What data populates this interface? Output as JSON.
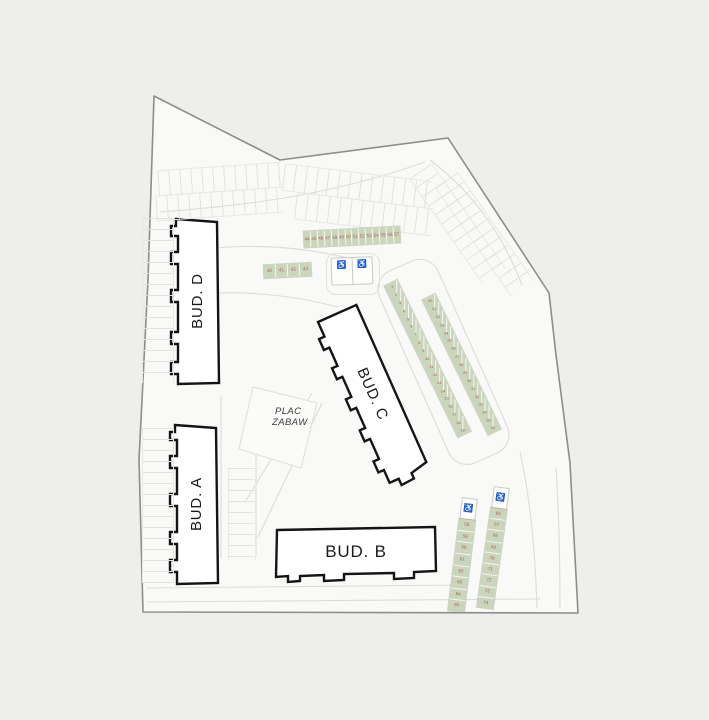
{
  "site_plan": {
    "buildings": {
      "building_d": "BUD. D",
      "building_a": "BUD. A",
      "building_c": "BUD. C",
      "building_b": "BUD. B"
    },
    "playground": {
      "line1": "PLAC",
      "line2": "ZABAW"
    },
    "parking": {
      "strip_top": {
        "spaces": [
          "44",
          "45",
          "46",
          "47",
          "48",
          "49",
          "50",
          "51",
          "52",
          "53",
          "54",
          "55",
          "56",
          "57"
        ]
      },
      "strip_small": {
        "spaces": [
          "40",
          "41",
          "42",
          "43"
        ]
      },
      "strip_diag_left": {
        "spaces": [
          "1",
          "2",
          "3",
          "4",
          "5",
          "6",
          "7",
          "8",
          "9",
          "10",
          "11",
          "12",
          "13",
          "14",
          "15",
          "16",
          "17",
          "18",
          "19"
        ]
      },
      "strip_diag_right": {
        "spaces": [
          "20",
          "21",
          "22",
          "23",
          "24",
          "25",
          "26",
          "27",
          "28",
          "29",
          "30",
          "31",
          "32",
          "33",
          "34",
          "35",
          "36"
        ]
      },
      "strip_bottom_left": {
        "spaces": [
          "58",
          "59",
          "60",
          "61",
          "62",
          "63",
          "64",
          "65"
        ],
        "accessible_icon": "♿"
      },
      "strip_bottom_right": {
        "spaces": [
          "66",
          "67",
          "68",
          "69",
          "70",
          "71",
          "72",
          "73",
          "74"
        ],
        "accessible_icon": "♿"
      },
      "accessible_pair": {
        "icon_left": "♿",
        "icon_right": "♿"
      }
    },
    "colors": {
      "bg_outer": "#eeeeec",
      "bg_inner": "#f9f9f7",
      "boundary": "#8d8d8d",
      "building_outline": "#141414",
      "strip_green": "#cbd5bc",
      "space_number": "#a2604f",
      "faint_line": "#dcdcda"
    }
  }
}
